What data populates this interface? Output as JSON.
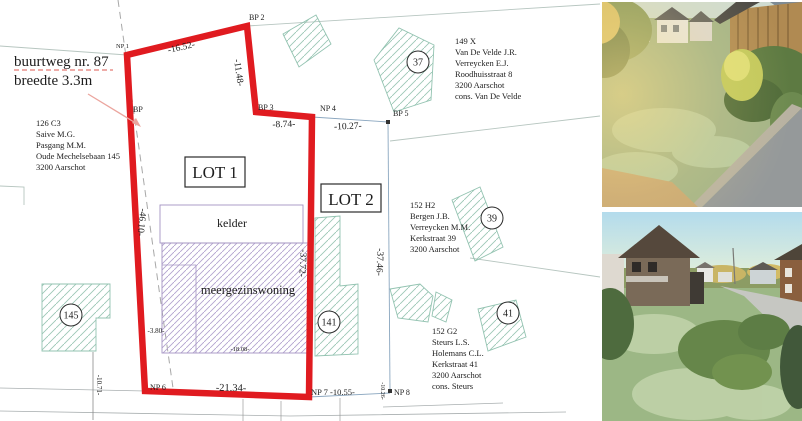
{
  "plan": {
    "red_note": {
      "line1": "buurtweg nr. 87",
      "line2": "breedte 3.3m"
    },
    "lot1": "LOT 1",
    "lot2": "LOT 2",
    "kelder": "kelder",
    "building": "meergezinswoning",
    "circles": {
      "c37": "37",
      "c39": "39",
      "c41": "41",
      "c141": "141",
      "c145": "145"
    },
    "owners": {
      "o126": [
        "126 C3",
        "Saive M.G.",
        "Pasgang M.M.",
        "Oude Mechelsebaan 145",
        "3200 Aarschot"
      ],
      "o149": [
        "149 X",
        "Van De Velde J.R.",
        "Verreycken E.J.",
        "Roodhuisstraat 8",
        "3200 Aarschot",
        "cons. Van De Velde"
      ],
      "o152h": [
        "152 H2",
        "Bergen J.B.",
        "Verreycken M.M.",
        "Kerkstraat 39",
        "3200 Aarschot"
      ],
      "o152g": [
        "152 G2",
        "Steurs L.S.",
        "Holemans C.L.",
        "Kerkstraat 41",
        "3200 Aarschot",
        "cons. Steurs"
      ]
    },
    "points": {
      "np1": "NP 1",
      "bp2": "BP 2",
      "bp": "BP",
      "bp3": "BP 3",
      "np4": "NP 4",
      "bp5": "BP 5",
      "np6": "NP 6",
      "np7": "NP 7 -10.55-",
      "np8": "NP 8"
    },
    "dims": {
      "d1652": "-16.52-",
      "d1148": "-11.48-",
      "d874": "-8.74-",
      "d1027": "-10.27-",
      "d4610": "-46.10-",
      "d3772": "-37.72-",
      "d3746": "-37.46-",
      "d2134": "-21.34-",
      "d1071": "-10.71-",
      "d1026": "-10.26-",
      "d380": "-3.80-",
      "d1808": "-18.08-"
    }
  },
  "colors": {
    "boundary_red": "#e01b20",
    "note_red": "#dd5a50",
    "teal_hatch": "#93c3b1",
    "purple": "#a092c3"
  }
}
